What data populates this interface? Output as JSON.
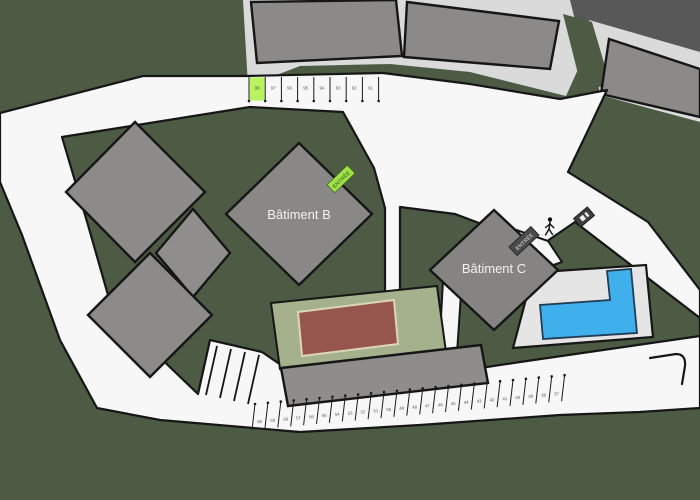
{
  "map": {
    "building_b_label": "Bâtiment B",
    "building_c_label": "Bâtiment C",
    "entrance_b_label": "ENTRÉE",
    "entrance_c_label": "ENTRÉE"
  },
  "parking": {
    "top_row": {
      "stalls": [
        "98",
        "97",
        "96",
        "95",
        "94",
        "93",
        "92",
        "91"
      ],
      "highlighted_stall": "98"
    },
    "bottom_row": {
      "stalls": [
        "60",
        "59",
        "58",
        "57",
        "56",
        "55",
        "54",
        "53",
        "52",
        "51",
        "50",
        "49",
        "48",
        "47",
        "46",
        "45",
        "44",
        "43",
        "42",
        "41",
        "40",
        "39",
        "38",
        "37"
      ]
    }
  },
  "icons": {
    "pedestrian": "pedestrian-icon",
    "sign": "sign-icon"
  },
  "colors": {
    "background_green": "#4d5a44",
    "road_white": "#f7f7f7",
    "building_gray": "#8c8a88",
    "surround_gray": "#dadada",
    "dark_corner_gray": "#585858",
    "outline_black": "#161616",
    "highlight_green": "#b9f25f",
    "entrance_b_green": "#9fe348",
    "entrance_c_gray": "#4a4a4a",
    "court_green": "#a4b18c",
    "court_red": "#96564e",
    "court_line_cream": "#ddd6b4",
    "pool_blue": "#3fb0ec",
    "pool_deck": "#e5e5e5"
  }
}
